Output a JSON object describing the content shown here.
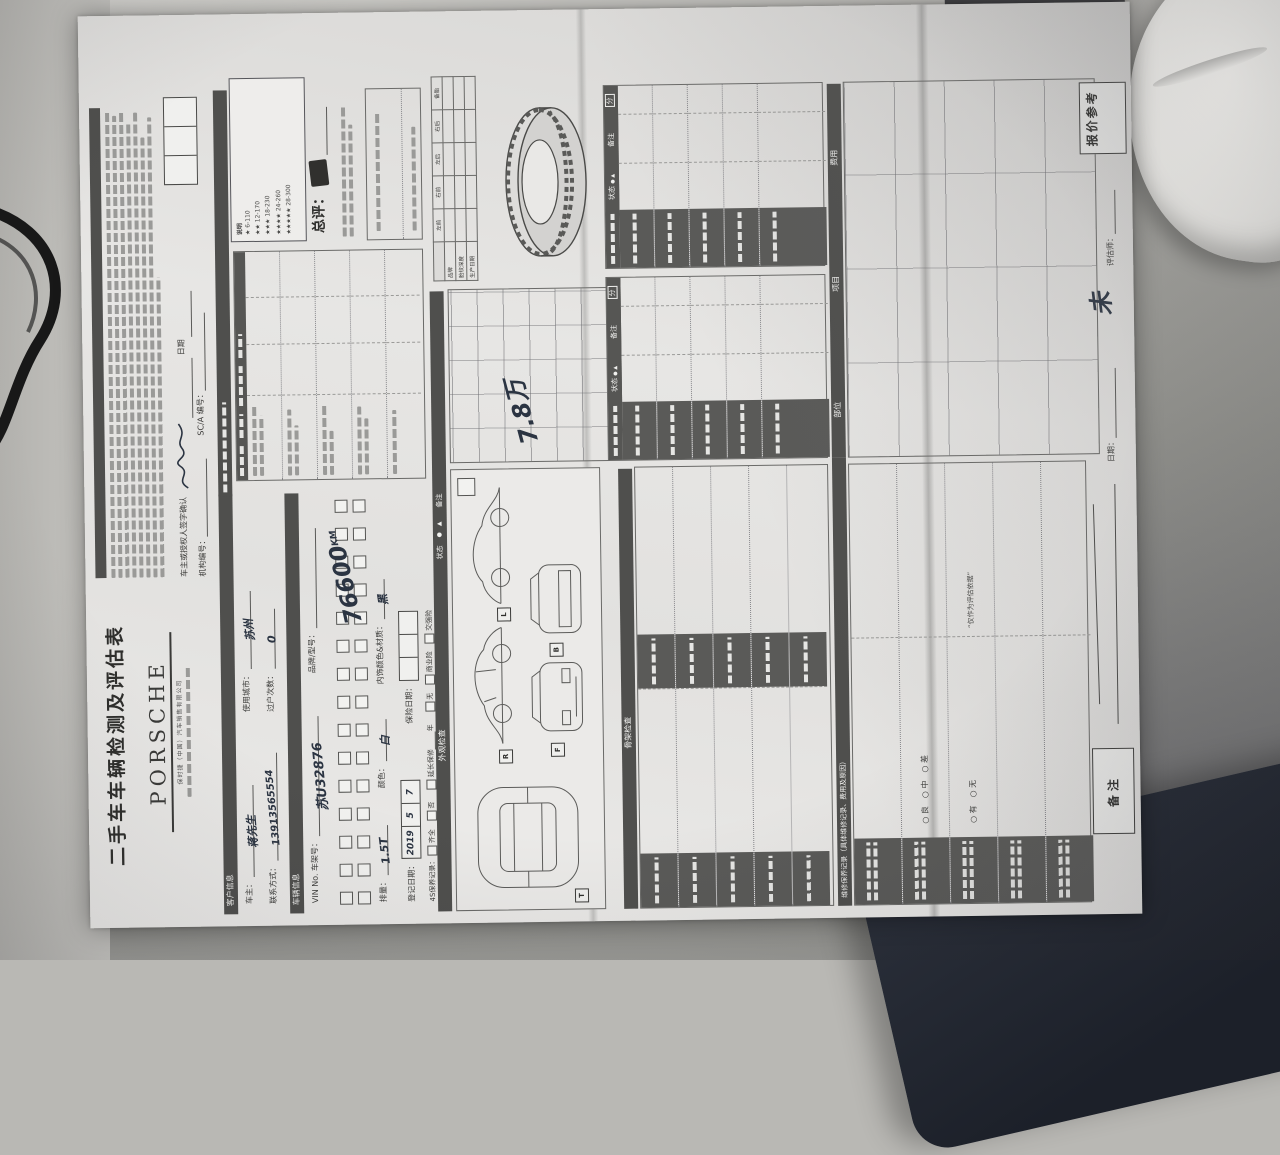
{
  "colors": {
    "paper": "#e7e6e4",
    "desk_light": "#d2d1cd",
    "desk_right": "#8a8a88",
    "cloth": "#edecea",
    "dark_corner": "#232832",
    "section_bar": "#4f4f4d",
    "ink": "#2b3442"
  },
  "header": {
    "title": "二手车车辆检测及评估表",
    "brand": "PORSCHE",
    "brand_sub": "保时捷（中国）汽车销售有限公司",
    "sign_confirm": "车主或授权人签字确认",
    "date_label": "日期",
    "org_no": "机构编号：",
    "sc_no": "SC/A 编号："
  },
  "sections": {
    "customer": "客户信息",
    "vehicle": "车辆信息",
    "exterior": "外观检查",
    "frame": "骨架检查",
    "maintenance": "维修保养记录（具体维修记录、费用及原因）"
  },
  "customer": {
    "fields": [
      {
        "label": "车主：",
        "value": "蒋先生"
      },
      {
        "label": "联系方式：",
        "value": "13913565554"
      },
      {
        "label": "使用城市：",
        "value": "苏州"
      },
      {
        "label": "过户次数：",
        "value": "0"
      }
    ]
  },
  "vehicle": {
    "vin_label": "VIN No. 车架号：",
    "vin_value": "苏U32876",
    "brand_label": "品牌/型号：",
    "disp_label": "排量：",
    "disp_value": "1.5T",
    "color_label": "颜色：",
    "color_value": "白",
    "interior_label": "内饰颜色&材质：",
    "interior_value": "黑",
    "mileage_value": "76600",
    "mileage_unit": "KM",
    "reg_label": "登记日期：",
    "reg_parts": [
      "2019",
      "5",
      "7"
    ],
    "ins_label": "保险日期：",
    "svc_label": "4S保养记录：",
    "svc_opts": [
      "齐全",
      "否"
    ],
    "warranty": "延长保修",
    "warranty_unit": "年",
    "ins_opts": [
      "无",
      "商业险",
      "交强险"
    ]
  },
  "rating": {
    "note_title": "说明",
    "levels": [
      "★  6-110",
      "★★  12-170",
      "★★★  18-230",
      "★★★★  24-260",
      "★★★★★  28-300"
    ],
    "overall_label": "总评："
  },
  "tires": {
    "cols": [
      "左前",
      "右前",
      "左后",
      "右后",
      "备胎"
    ],
    "rows": [
      "品牌",
      "胎纹深度",
      "生产日期"
    ]
  },
  "roadtest": {
    "status": "状态",
    "legend": "●　▲",
    "remark": "备注",
    "hand_price": "7.8万"
  },
  "check_table": {
    "status": "状态",
    "legend": "● ▲",
    "remark": "备注",
    "score": "分"
  },
  "maintenance": {
    "cols": [
      "部位",
      "项目",
      "费用"
    ],
    "grade_opts": "○ 良　○ 中　○ 差",
    "yn_opts": "○ 有　○ 无",
    "quote": "“仅作为评估依据”"
  },
  "bottom": {
    "remark_box": "备注",
    "quote_box": "报价参考",
    "assessor": "评估师：",
    "date": "日期：",
    "hand": "未"
  },
  "diagram_tags": [
    "R",
    "L",
    "F",
    "B",
    "T"
  ]
}
